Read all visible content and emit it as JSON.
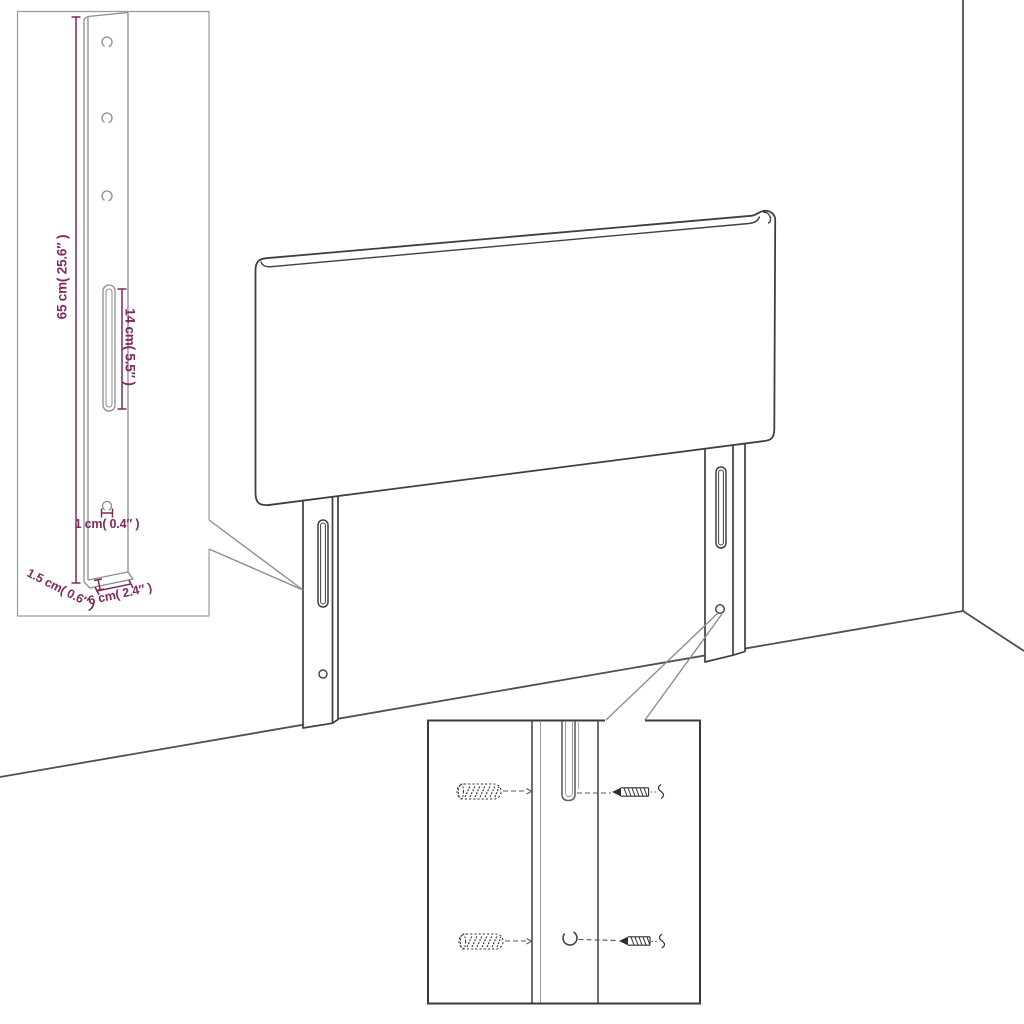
{
  "diagram": {
    "type": "furniture-headboard-dimension-diagram",
    "dimensions": {
      "bracket_height": "65 cm( 25.6″ )",
      "slot_length": "14 cm( 5.5″ )",
      "hole_diameter": "1 cm( 0.4″ )",
      "bracket_thickness": "1.5 cm( 0.6″ )",
      "bracket_width": "6 cm( 2.4″ )"
    },
    "colors": {
      "dimension_text": "#7e2a5d",
      "outline": "#3f3f3f",
      "wall_lines": "#4f4f4f",
      "inset_border": "#9b9b9b",
      "bracket_lines": "#8d8d8d",
      "detail_border": "#3a3a3a",
      "background": "#ffffff"
    }
  }
}
